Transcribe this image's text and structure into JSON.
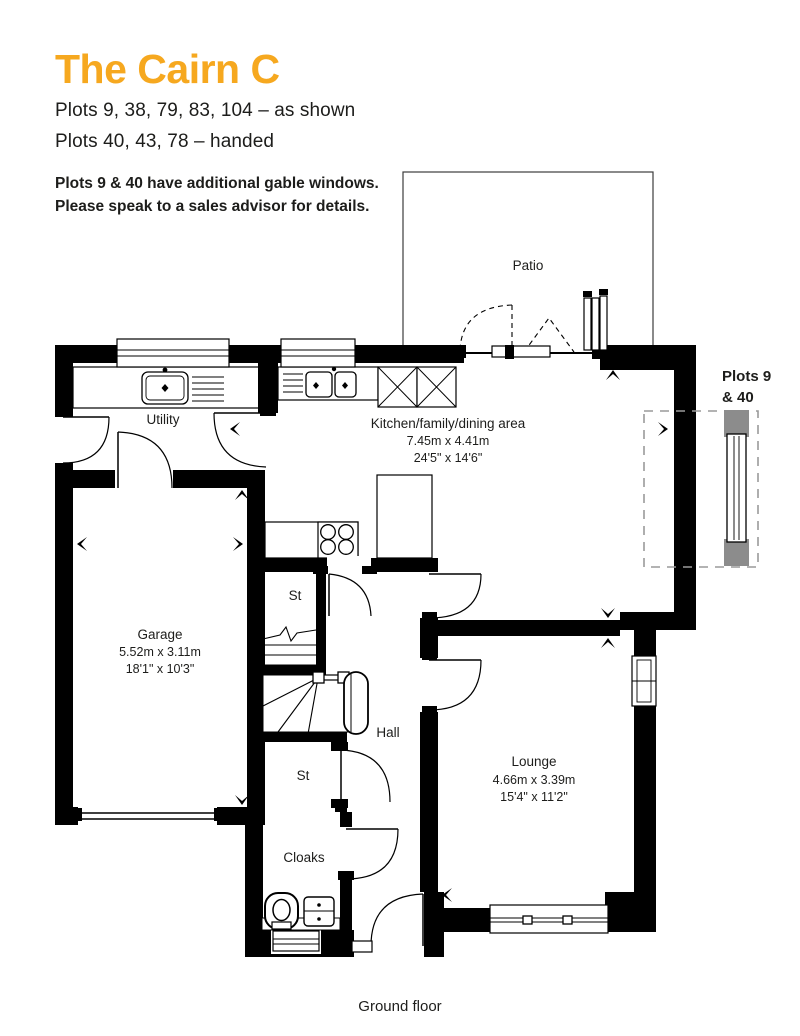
{
  "header": {
    "title": "The Cairn C",
    "plots_as_shown": "Plots 9, 38, 79, 83, 104 – as shown",
    "plots_handed": "Plots 40, 43, 78 – handed",
    "note_line1": "Plots 9 & 40 have additional gable windows.",
    "note_line2": "Please speak to a sales advisor for details."
  },
  "plan": {
    "patio_label": "Patio",
    "rooms": {
      "utility": {
        "name": "Utility"
      },
      "kitchen": {
        "name": "Kitchen/family/dining area",
        "metric": "7.45m x 4.41m",
        "imperial": "24'5\" x 14'6\""
      },
      "garage": {
        "name": "Garage",
        "metric": "5.52m x 3.11m",
        "imperial": "18'1\" x 10'3\""
      },
      "lounge": {
        "name": "Lounge",
        "metric": "4.66m x 3.39m",
        "imperial": "15'4\" x 11'2\""
      },
      "hall": {
        "name": "Hall"
      },
      "store_upper": {
        "name": "St"
      },
      "store_lower": {
        "name": "St"
      },
      "cloaks": {
        "name": "Cloaks"
      }
    },
    "annotation": {
      "line1": "Plots 9",
      "line2": "& 40"
    },
    "floor_label": "Ground floor"
  },
  "colors": {
    "accent_orange": "#F6A81F",
    "wall_black": "#000000",
    "detail_gray": "#8C8C8C",
    "dash_gray": "#9A9A9A",
    "text": "#1D1D1B"
  }
}
